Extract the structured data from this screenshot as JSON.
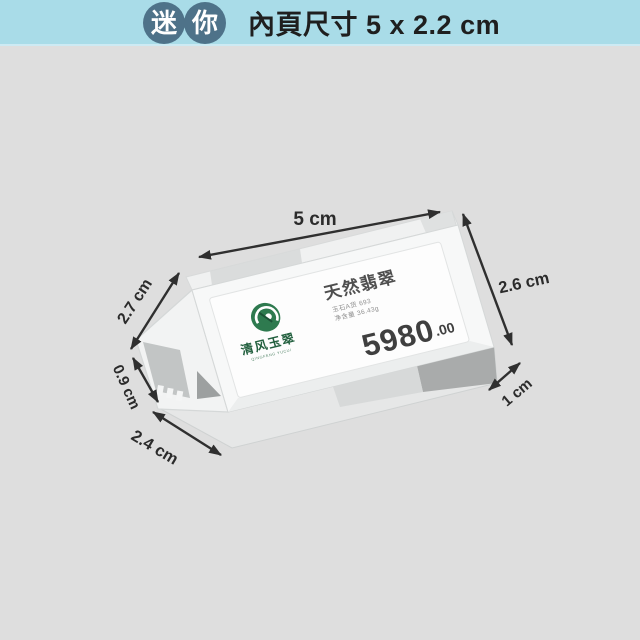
{
  "header": {
    "badge_left": "迷",
    "badge_right": "你",
    "title": "內頁尺寸 5 x 2.2 cm"
  },
  "dimensions": {
    "top": "5 cm",
    "right": "2.6 cm",
    "left_upper": "2.7 cm",
    "left_lower": "0.9 cm",
    "bottom_left": "2.4 cm",
    "bottom_right": "1 cm"
  },
  "product": {
    "label": {
      "title": "天然翡翠",
      "info_line1": "玉石A货 693",
      "info_line2": "净含量 36.43g",
      "price": "5980",
      "price_decimals": ".00",
      "brand": "清风玉翠",
      "brand_sub": "QINGFENG YUCUI"
    }
  },
  "colors": {
    "topbar_bg": "#a9dce8",
    "badge_bg": "#4e7289",
    "stage_bg": "#dedede",
    "arrow": "#2f2f2f",
    "brand_green": "#2e7a4f",
    "price_text": "#3f3f3f"
  }
}
